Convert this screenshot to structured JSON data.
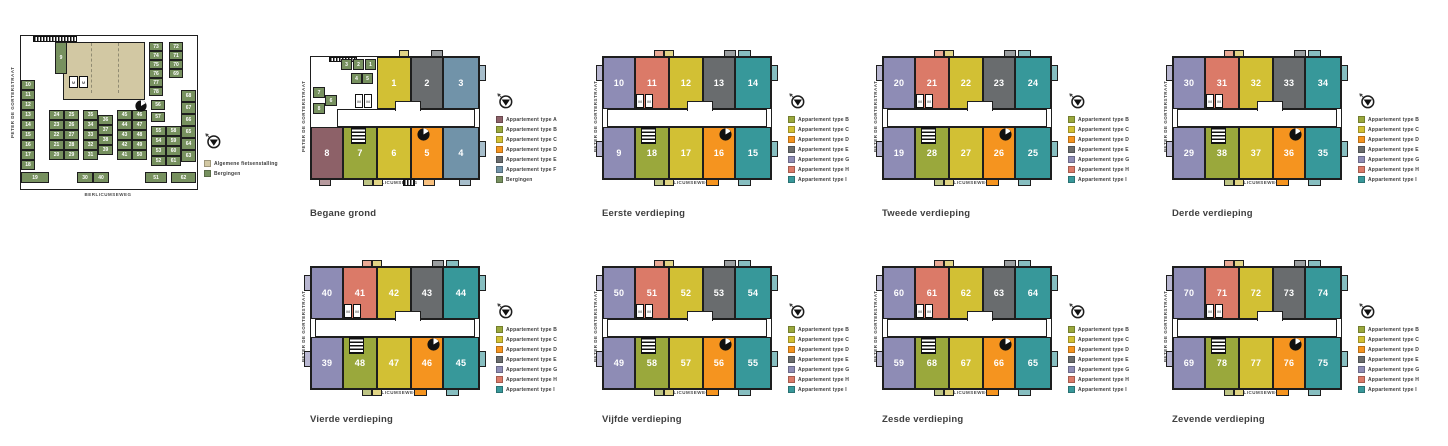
{
  "streets": {
    "left": "PETER DE GORTERSTRAAT",
    "bottom": "BERLICUMSEWEG"
  },
  "type_colors": {
    "A": "#8d6168",
    "B": "#9aa83c",
    "C": "#d2c034",
    "D": "#f5941f",
    "E": "#696c6e",
    "F": "#7193a9",
    "G": "#8e8cb5",
    "H": "#db7a68",
    "I": "#37989a",
    "bergingen": "#77915f",
    "fietsenstalling": "#d2c8a3"
  },
  "type_colors_light": {
    "A": "#b79a9e",
    "B": "#bdc483",
    "C": "#e1d585",
    "D": "#f8c07e",
    "E": "#9b9ea0",
    "F": "#a7becb",
    "G": "#b8b6d0",
    "H": "#eaa995",
    "I": "#87bec0",
    "bergingen": "#a9bd8d"
  },
  "legend_labels": {
    "A": "Appartement type A",
    "B": "Appartement type B",
    "C": "Appartement type C",
    "D": "Appartement type D",
    "E": "Appartement type E",
    "F": "Appartement type F",
    "G": "Appartement type G",
    "H": "Appartement type H",
    "I": "Appartement type I",
    "bergingen": "Bergingen",
    "fietsenstalling": "Algemene fietsenstalling"
  },
  "meter_label": "M",
  "storage_plan": {
    "legend": [
      "fietsenstalling",
      "bergingen"
    ],
    "cell_9": "9",
    "left_column": [
      "10",
      "11",
      "12",
      "13",
      "14",
      "15",
      "16",
      "17",
      "18"
    ],
    "left_bottom": "19",
    "block1": {
      "left": [
        "24",
        "23",
        "22",
        "21",
        "20"
      ],
      "right": [
        "25",
        "26",
        "27",
        "28",
        "29"
      ]
    },
    "block2": {
      "left": [
        "35",
        "34",
        "33",
        "32",
        "31"
      ],
      "right": [
        "36",
        "37",
        "38",
        "39"
      ],
      "bottom": [
        "30",
        "40"
      ]
    },
    "block3": {
      "left": [
        "45",
        "44",
        "43",
        "42",
        "41"
      ],
      "right": [
        "46",
        "47",
        "48",
        "49",
        "50"
      ]
    },
    "block4": {
      "top": [
        "56",
        "57"
      ],
      "left": [
        "55",
        "54",
        "53",
        "52"
      ],
      "right": [
        "58",
        "59",
        "60",
        "61"
      ],
      "bottom": "51"
    },
    "right_column": [
      "68",
      "67",
      "66",
      "65",
      "64",
      "63"
    ],
    "right_bottom": "62",
    "top_right_a": [
      "73",
      "74",
      "75",
      "76",
      "77",
      "78"
    ],
    "top_right_b": [
      "72",
      "71",
      "70",
      "69"
    ]
  },
  "floors": [
    {
      "key": "f0",
      "title": "Begane grond",
      "variant": "ground",
      "top": [
        {
          "no": "1",
          "type": "C"
        },
        {
          "no": "2",
          "type": "E"
        },
        {
          "no": "3",
          "type": "F"
        }
      ],
      "bottom": [
        {
          "no": "8",
          "type": "A"
        },
        {
          "no": "7",
          "type": "B"
        },
        {
          "no": "6",
          "type": "C"
        },
        {
          "no": "5",
          "type": "D"
        },
        {
          "no": "4",
          "type": "F"
        }
      ],
      "storage": {
        "row1": [
          "3",
          "2",
          "1"
        ],
        "row2": [
          "4",
          "5"
        ],
        "left": [
          "7",
          "6",
          "8"
        ]
      },
      "legend": [
        "A",
        "B",
        "C",
        "D",
        "E",
        "F",
        "bergingen"
      ]
    },
    {
      "key": "f1",
      "title": "Eerste verdieping",
      "variant": "standard",
      "top": [
        {
          "no": "10",
          "type": "G"
        },
        {
          "no": "11",
          "type": "H"
        },
        {
          "no": "12",
          "type": "C"
        },
        {
          "no": "13",
          "type": "E"
        },
        {
          "no": "14",
          "type": "I"
        }
      ],
      "bottom": [
        {
          "no": "9",
          "type": "G"
        },
        {
          "no": "18",
          "type": "B"
        },
        {
          "no": "17",
          "type": "C"
        },
        {
          "no": "16",
          "type": "D"
        },
        {
          "no": "15",
          "type": "I"
        }
      ],
      "legend": [
        "B",
        "C",
        "D",
        "E",
        "G",
        "H",
        "I"
      ]
    },
    {
      "key": "f2",
      "title": "Tweede verdieping",
      "variant": "standard",
      "top": [
        {
          "no": "20",
          "type": "G"
        },
        {
          "no": "21",
          "type": "H"
        },
        {
          "no": "22",
          "type": "C"
        },
        {
          "no": "23",
          "type": "E"
        },
        {
          "no": "24",
          "type": "I"
        }
      ],
      "bottom": [
        {
          "no": "19",
          "type": "G"
        },
        {
          "no": "28",
          "type": "B"
        },
        {
          "no": "27",
          "type": "C"
        },
        {
          "no": "26",
          "type": "D"
        },
        {
          "no": "25",
          "type": "I"
        }
      ],
      "legend": [
        "B",
        "C",
        "D",
        "E",
        "G",
        "H",
        "I"
      ]
    },
    {
      "key": "f3",
      "title": "Derde verdieping",
      "variant": "standard",
      "top": [
        {
          "no": "30",
          "type": "G"
        },
        {
          "no": "31",
          "type": "H"
        },
        {
          "no": "32",
          "type": "C"
        },
        {
          "no": "33",
          "type": "E"
        },
        {
          "no": "34",
          "type": "I"
        }
      ],
      "bottom": [
        {
          "no": "29",
          "type": "G"
        },
        {
          "no": "38",
          "type": "B"
        },
        {
          "no": "37",
          "type": "C"
        },
        {
          "no": "36",
          "type": "D"
        },
        {
          "no": "35",
          "type": "I"
        }
      ],
      "legend": [
        "B",
        "C",
        "D",
        "E",
        "G",
        "H",
        "I"
      ]
    },
    {
      "key": "f4",
      "title": "Vierde verdieping",
      "variant": "standard",
      "top": [
        {
          "no": "40",
          "type": "G"
        },
        {
          "no": "41",
          "type": "H"
        },
        {
          "no": "42",
          "type": "C"
        },
        {
          "no": "43",
          "type": "E"
        },
        {
          "no": "44",
          "type": "I"
        }
      ],
      "bottom": [
        {
          "no": "39",
          "type": "G"
        },
        {
          "no": "48",
          "type": "B"
        },
        {
          "no": "47",
          "type": "C"
        },
        {
          "no": "46",
          "type": "D"
        },
        {
          "no": "45",
          "type": "I"
        }
      ],
      "legend": [
        "B",
        "C",
        "D",
        "E",
        "G",
        "H",
        "I"
      ]
    },
    {
      "key": "f5",
      "title": "Vijfde verdieping",
      "variant": "standard",
      "top": [
        {
          "no": "50",
          "type": "G"
        },
        {
          "no": "51",
          "type": "H"
        },
        {
          "no": "52",
          "type": "C"
        },
        {
          "no": "53",
          "type": "E"
        },
        {
          "no": "54",
          "type": "I"
        }
      ],
      "bottom": [
        {
          "no": "49",
          "type": "G"
        },
        {
          "no": "58",
          "type": "B"
        },
        {
          "no": "57",
          "type": "C"
        },
        {
          "no": "56",
          "type": "D"
        },
        {
          "no": "55",
          "type": "I"
        }
      ],
      "legend": [
        "B",
        "C",
        "D",
        "E",
        "G",
        "H",
        "I"
      ]
    },
    {
      "key": "f6",
      "title": "Zesde verdieping",
      "variant": "standard",
      "top": [
        {
          "no": "60",
          "type": "G"
        },
        {
          "no": "61",
          "type": "H"
        },
        {
          "no": "62",
          "type": "C"
        },
        {
          "no": "63",
          "type": "E"
        },
        {
          "no": "64",
          "type": "I"
        }
      ],
      "bottom": [
        {
          "no": "59",
          "type": "G"
        },
        {
          "no": "68",
          "type": "B"
        },
        {
          "no": "67",
          "type": "C"
        },
        {
          "no": "66",
          "type": "D"
        },
        {
          "no": "65",
          "type": "I"
        }
      ],
      "legend": [
        "B",
        "C",
        "D",
        "E",
        "G",
        "H",
        "I"
      ]
    },
    {
      "key": "f7",
      "title": "Zevende verdieping",
      "variant": "standard",
      "top": [
        {
          "no": "70",
          "type": "G"
        },
        {
          "no": "71",
          "type": "H"
        },
        {
          "no": "72",
          "type": "C"
        },
        {
          "no": "73",
          "type": "E"
        },
        {
          "no": "74",
          "type": "I"
        }
      ],
      "bottom": [
        {
          "no": "69",
          "type": "G"
        },
        {
          "no": "78",
          "type": "B"
        },
        {
          "no": "77",
          "type": "C"
        },
        {
          "no": "76",
          "type": "D"
        },
        {
          "no": "75",
          "type": "I"
        }
      ],
      "legend": [
        "B",
        "C",
        "D",
        "E",
        "G",
        "H",
        "I"
      ]
    }
  ]
}
